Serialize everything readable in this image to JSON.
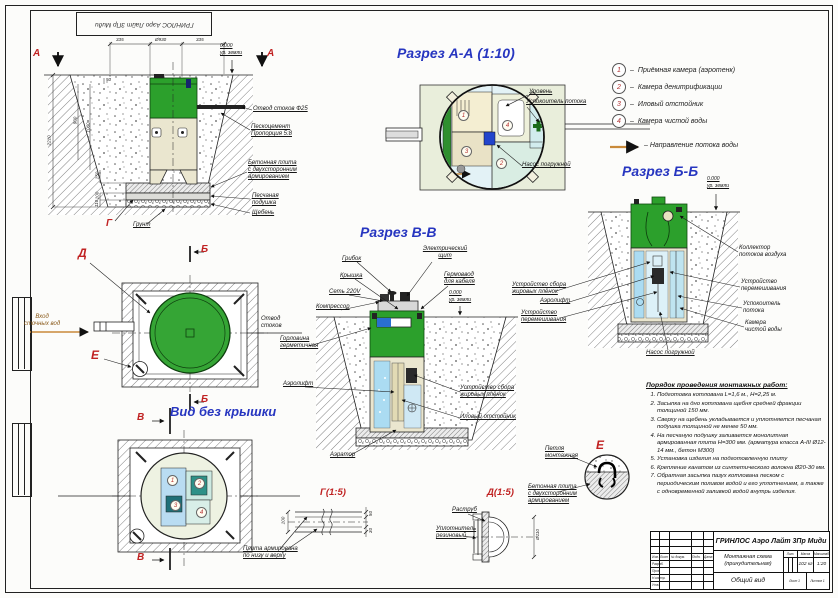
{
  "markers": {
    "a": "А",
    "b": "Б",
    "v": "В",
    "g": "Г",
    "d": "Д",
    "e": "Е"
  },
  "levels": {
    "zero": "0.000",
    "ground": "ур. земли"
  },
  "section_titles": {
    "aa": "Разрез А-А (1:10)",
    "vv": "Разрез В-В",
    "bb": "Разрез Б-Б",
    "no_cover": "Вид без крышки",
    "det_g": "Г(1:5)",
    "det_d": "Д(1:5)"
  },
  "corner_stamp": "ГРИНЛОС Аэро Лайт 3Пр Миди",
  "front_view": {
    "dims": {
      "left_offset": "335",
      "diameter": "Ø930",
      "right_offset": "335",
      "total_depth": "2210",
      "h900": "900",
      "h1060": "1060",
      "h50": "50",
      "h150": "150",
      "h100": "100",
      "h110": "110"
    },
    "labels": {
      "outlet": "Отвод стоков Ф25",
      "sand_cement": "Пескоцемент\nПропорция 5:8",
      "slab": "Бетонная плита\nс двухсторонним\nармированием",
      "sand": "Песчаная\nподушка",
      "gravel": "Щебень",
      "soil": "Грунт"
    }
  },
  "plan_view": {
    "inlet": "Вход\nсточных вод",
    "outlet": "Отвод\nстоков"
  },
  "aa_view": {
    "level": "Уровень",
    "calmer": "Успокоитель потока",
    "pump": "Насос погружной"
  },
  "vv_view": {
    "mushroom": "Грибок",
    "cover": "Крышка",
    "power": "Сеть 220V",
    "compressor": "Компрессор",
    "panel": "Электрический\nщит",
    "gland": "Гермоввод\nдля кабеля",
    "neck": "Горловина\nгерметичная",
    "airlift": "Аэролифт",
    "grease": "Устройство сбора\nжировых плёнок",
    "sludge": "Иловый отстойник",
    "aerator": "Аэратор"
  },
  "bb_view": {
    "collector": "Коллектор\nпотоков воздуха",
    "mixer_right": "Устройство\nперемешивания",
    "calmer": "Успокоитель\nпотока",
    "clean_chamber": "Камера\nчистой воды",
    "grease": "Устройство сбора\nжировых плёнок",
    "airlift": "Аэролифт",
    "mixer_left": "Устройство\nперемешивания",
    "pump": "Насос погружной"
  },
  "details": {
    "g_label": "Плита армирована\nпо низу и верху",
    "g_d100": "100",
    "g_d50": "50",
    "g_d30": "30",
    "d_socket": "Раструб",
    "d_seal": "Уплотнитель\nрезиновый",
    "d_dia": "Ø110",
    "e_loop": "Петля\nмонтажная",
    "e_slab": "Бетонная плита\nс двухсторонним\nармированием"
  },
  "legend": {
    "dash": "–",
    "items": [
      {
        "num": "1",
        "text": "Приёмная камера (аэротенк)"
      },
      {
        "num": "2",
        "text": "Камера денитрификации"
      },
      {
        "num": "3",
        "text": "Иловый отстойник"
      },
      {
        "num": "4",
        "text": "Камера чистой воды"
      }
    ],
    "flow": "Направление потока воды"
  },
  "instructions": {
    "title": "Порядок проведения монтажных работ:",
    "items": [
      "Подготовка котлована L=1,6 м., H=2,25 м.",
      "Засыпка на дно котлована щебня средней фракции толщиной 150 мм.",
      "Сверху на щебень укладывается и уплотняется песчаная подушка толщиной не менее 50 мм.",
      "На песчаную подушку заливается монолитная армированная плита Н=300 мм. (арматура класса А-III Ø12-14 мм., бетон М300)",
      "Установка изделия на подготовленную плиту",
      "Крепление канатом из синтетического волокна Ø20-30 мм.",
      "Обратная засыпка пазух котлована песком с периодическим поливом водой и его уплотнением, а также с одновременной заливкой водой внутрь изделия."
    ]
  },
  "title_block": {
    "product": "ГРИНЛОС Аэро Лайт 3Пр Миди",
    "doc_name": "Монтажная схема\n(принудительная)",
    "view_name": "Общий вид",
    "lit": "Лит.",
    "mass_h": "Масса",
    "scale_h": "Масштаб",
    "mass": "102 кг",
    "scale": "1:20",
    "sheet_label": "Лист 1",
    "sheets_label": "Листов 1",
    "col_izm": "Изм.",
    "col_list": "Лист",
    "col_doc": "№ докум.",
    "col_sign": "Подп.",
    "col_date": "Дата",
    "row_dev": "Разраб.",
    "row_check": "Пров.",
    "row_ncontr": "Н.контр.",
    "row_appr": "Утв."
  }
}
